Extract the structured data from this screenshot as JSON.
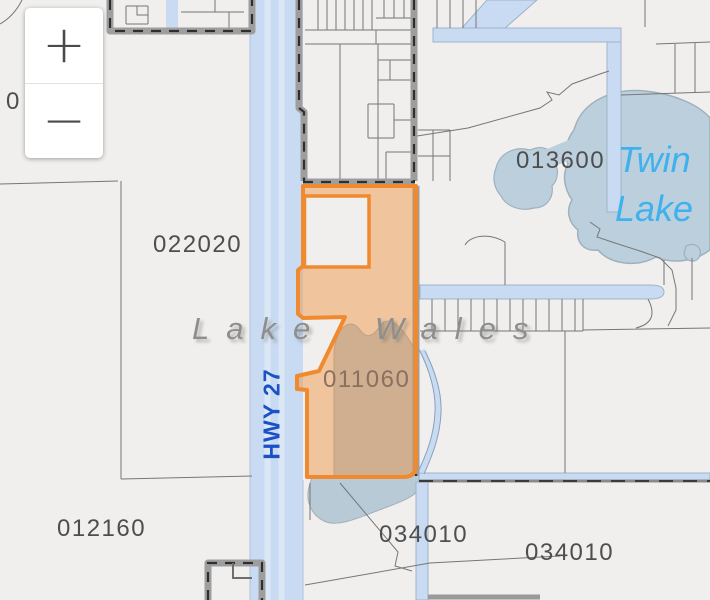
{
  "zoom_control": {
    "zoom_in_symbol": "+",
    "zoom_out_symbol": "−"
  },
  "map_labels": {
    "parcels": [
      {
        "text": "022020"
      },
      {
        "text": "013600"
      },
      {
        "text": "011060"
      },
      {
        "text": "012160"
      },
      {
        "text": "034010"
      },
      {
        "text": "034010"
      },
      {
        "text": "0"
      }
    ],
    "city": "Lake Wales",
    "lake_line1": "Twin",
    "lake_line2": "Lake",
    "highway": "HWY 27"
  },
  "colors": {
    "highlight_orange": "#F08A2E",
    "road_blue": "#C8DBF2",
    "water_blue": "#BCCFDD",
    "highway_text": "#1A52C5",
    "lake_text": "#3EB1EE",
    "label_gray": "#4E4E4E"
  }
}
